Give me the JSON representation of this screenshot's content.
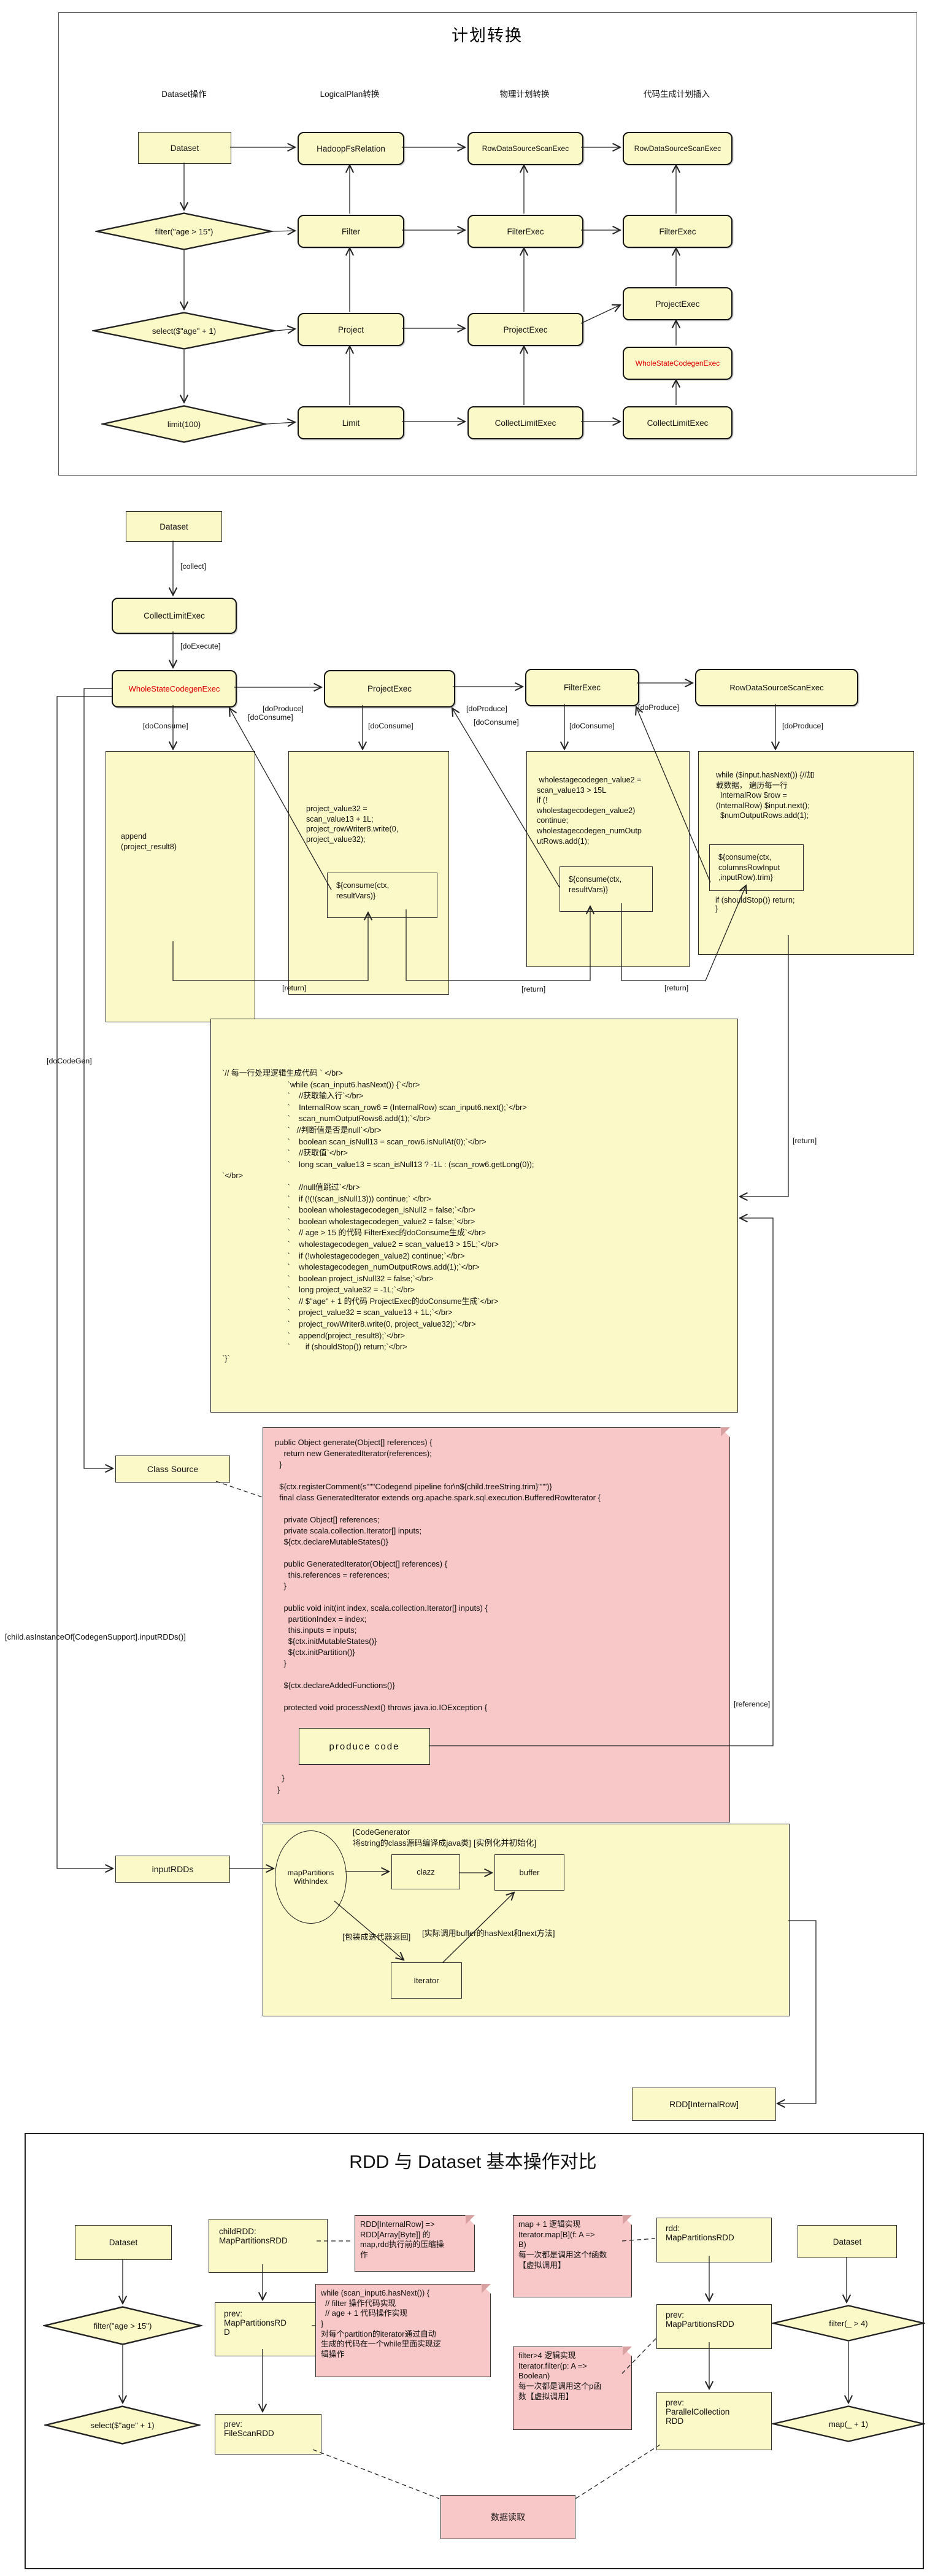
{
  "colors": {
    "node_fill": "#fbf9c8",
    "note_fill": "#f8c8c8",
    "accent_red": "#e00000"
  },
  "s1": {
    "title": "计划转换",
    "headers": [
      "Dataset操作",
      "LogicalPlan转换",
      "物理计划转换",
      "代码生成计划插入"
    ],
    "dataset": "Dataset",
    "ops": [
      "filter(\"age > 15\")",
      "select($\"age\" + 1)",
      "limit(100)"
    ],
    "logical": [
      "HadoopFsRelation",
      "Filter",
      "Project",
      "Limit"
    ],
    "physical": [
      "RowDataSourceScanExec",
      "FilterExec",
      "ProjectExec",
      "CollectLimitExec"
    ],
    "codegen": [
      "RowDataSourceScanExec",
      "FilterExec",
      "ProjectExec",
      "WholeStateCodegenExec",
      "CollectLimitExec"
    ]
  },
  "s2": {
    "dataset": "Dataset",
    "collect": "[collect]",
    "collect_limit_exec": "CollectLimitExec",
    "do_execute": "[doExecute]",
    "whole_stage": "WholeStateCodegenExec",
    "project_exec": "ProjectExec",
    "filter_exec": "FilterExec",
    "scan_exec": "RowDataSourceScanExec",
    "do_produce": "[doProduce]",
    "do_consume": "[doConsume]",
    "ret": "[return]",
    "append_code": "append\n(project_result8)",
    "project_code": "project_value32 =\nscan_value13 + 1L;\nproject_rowWriter8.write(0,\nproject_value32);",
    "consume_resultvars": "${consume(ctx,\nresultVars)}",
    "filter_code": " wholestagecodegen_value2 =\nscan_value13 > 15L\nif (!\nwholestagecodegen_value2)\ncontinue;\nwholestagecodegen_numOutp\nutRows.add(1);",
    "scan_code": "while ($input.hasNext()) {//加\n载数据， 遍历每一行\n  InternalRow $row =\n(InternalRow) $input.next();\n  $numOutputRows.add(1);",
    "consume_columns": "${consume(ctx,\ncolumnsRowInput\n,inputRow).trim}",
    "scan_code_tail": "if (shouldStop()) return;\n}"
  },
  "produce": {
    "title": "produce  code",
    "code": "`// 每一行处理逻辑生成代码 ` </br>\n                              `while (scan_input6.hasNext()) {`</br>\n                              `    //获取输入行`</br>\n                              `    InternalRow scan_row6 = (InternalRow) scan_input6.next();`</br>\n                              `    scan_numOutputRows6.add(1);`</br>\n                              `   //判断值是否是null`</br>\n                              `    boolean scan_isNull13 = scan_row6.isNullAt(0);`</br>\n                              `    //获取值`</br>\n                              `    long scan_value13 = scan_isNull13 ? -1L : (scan_row6.getLong(0));\n`</br>\n                              `    //null值跳过`</br>\n                              `    if (!(!(scan_isNull13))) continue;` </br>\n                              `    boolean wholestagecodegen_isNull2 = false;`</br>\n                              `    boolean wholestagecodegen_value2 = false;`</br>\n                              `    // age > 15 的代码 FilterExec的doConsume生成`</br>\n                              `    wholestagecodegen_value2 = scan_value13 > 15L;`</br>\n                              `    if (!wholestagecodegen_value2) continue;`</br>\n                              `    wholestagecodegen_numOutputRows.add(1);`</br>\n                              `    boolean project_isNull32 = false;`</br>\n                              `    long project_value32 = -1L;`</br>\n                              `    // $\"age\" + 1 的代码 ProjectExec的doConsume生成`</br>\n                              `    project_value32 = scan_value13 + 1L;`</br>\n                              `    project_rowWriter8.write(0, project_value32);`</br>\n                              `    append(project_result8);`</br>\n                              `       if (shouldStop()) return;`</br>\n`}`"
  },
  "classsrc": {
    "label": "Class Source",
    "do_codegen": "[doCodeGen]",
    "input_rdds_call": "[child.asInstanceOf[CodegenSupport].inputRDDs()]",
    "reference": "[reference]",
    "code_top": "public Object generate(Object[] references) {\n    return new GeneratedIterator(references);\n  }\n\n  ${ctx.registerComment(s\"\"\"Codegend pipeline for\\n${child.treeString.trim}\"\"\")}\n  final class GeneratedIterator extends org.apache.spark.sql.execution.BufferedRowIterator {\n\n    private Object[] references;\n    private scala.collection.Iterator[] inputs;\n    ${ctx.declareMutableStates()}\n\n    public GeneratedIterator(Object[] references) {\n      this.references = references;\n    }\n\n    public void init(int index, scala.collection.Iterator[] inputs) {\n      partitionIndex = index;\n      this.inputs = inputs;\n      ${ctx.initMutableStates()}\n      ${ctx.initPartition()}\n    }\n\n    ${ctx.declareAddedFunctions()}\n\n    protected void processNext() throws java.io.IOException {",
    "produce_ref": "produce  code",
    "code_bottom": "  }\n}"
  },
  "rddgen": {
    "input_rdds": "inputRDDs",
    "codegen_note": "[CodeGenerator\n将string的class源码编译成java类]",
    "init_note": "[实例化并初始化]",
    "map_partitions": "mapPartitions\nWithIndex",
    "clazz": "clazz",
    "buffer": "buffer",
    "iterator": "Iterator",
    "wrap_note": "[包装成迭代器返回]",
    "call_note": "[实际调用buffer的hasNext和next方法]",
    "rdd_internal_row": "RDD[InternalRow]"
  },
  "cmp": {
    "title": "RDD 与 Dataset 基本操作对比",
    "dataset_left": "Dataset",
    "filter_left": "filter(\"age > 15\")",
    "select_left": "select($\"age\" + 1)",
    "child_rdd": "childRDD:\nMapPartitionsRDD",
    "prev_map_left": "prev:\nMapPartitionsRD\nD",
    "prev_filescan": "prev:\nFileScanRDD",
    "note_compress": "RDD[InternalRow] =>\nRDD[Array[Byte]] 的\nmap,rdd执行前的压缩操\n作",
    "note_while": "while (scan_input6.hasNext()) {\n  // filter 操作代码实现\n  // age + 1 代码操作实现\n}\n对每个partition的iterator通过自动\n生成的代码在一个while里面实现逻\n辑操作",
    "note_map": "map + 1 逻辑实现\nIterator.map[B](f: A =>\nB)\n每一次都是调用这个f函数\n【虚拟调用】",
    "note_filter": "filter>4 逻辑实现\nIterator.filter(p: A =>\nBoolean)\n每一次都是调用这个p函\n数【虚拟调用】",
    "rdd_map": "rdd:\nMapPartitionsRDD",
    "prev_map_right": "prev:\nMapPartitionsRDD",
    "prev_parallel": "prev:\nParallelCollection\nRDD",
    "dataset_right": "Dataset",
    "filter_right": "filter(_ > 4)",
    "map_right": "map(_ + 1)",
    "data_read": "数据读取"
  }
}
